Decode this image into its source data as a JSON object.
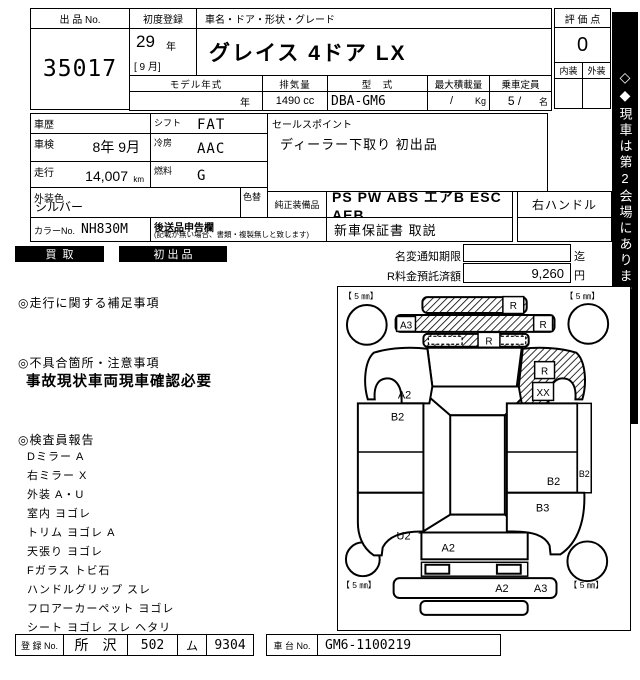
{
  "header": {
    "lot_label": "出 品 No.",
    "lot_no": "35017",
    "first_reg_label": "初度登録",
    "first_reg_year": "29",
    "first_reg_year_unit": "年",
    "first_reg_month": "[ 9 月]",
    "name_header": "車名・ドア・形状・グレード",
    "car_name": "グレイス 4ドア  LX",
    "model_year_label": "モデル年式",
    "model_year_unit": "年",
    "disp_label": "排気量",
    "disp_value": "1490 cc",
    "type_label": "型　式",
    "type_value": "DBA-GM6",
    "payload_label": "最大積載量",
    "payload_value": "/",
    "payload_unit": "Kg",
    "capacity_label": "乗車定員",
    "capacity_value": "5 /",
    "capacity_unit": "名",
    "score_label": "評 価 点",
    "score_value": "0",
    "interior_label": "内装",
    "exterior_label": "外装"
  },
  "specs": {
    "history_label": "車歴",
    "shift_label": "シフト",
    "shift_value": "FAT",
    "inspection_label": "車検",
    "inspection_value": "8年 9月",
    "cooling_label": "冷房",
    "cooling_value": "AAC",
    "mileage_label": "走行",
    "mileage_value": "14,007",
    "mileage_unit": "km",
    "fuel_label": "燃料",
    "fuel_value": "G",
    "ext_color_label": "外装色",
    "ext_color_value": "シルバー",
    "repaint_label": "色替",
    "color_no_label": "カラーNo.",
    "color_no_value": "NH830M",
    "later_label": "後送品申告欄",
    "later_note": "(記載が無い場合、書類・複製無しと致します)"
  },
  "sales": {
    "point_label": "セールスポイント",
    "point_text": "ディーラー下取り 初出品",
    "equip_label": "純正装備品",
    "equip_value": "PS PW ABS エアB ESC AEB",
    "handle_value": "右ハンドル",
    "docs_value": "新車保証書 取説"
  },
  "badges": {
    "buyout": "買取",
    "first_listing": "初出品"
  },
  "notice": {
    "name_change_label": "名変通知期限",
    "name_change_suffix": "迄",
    "deposit_label": "R料金預託済額",
    "deposit_value": "9,260",
    "deposit_unit": "円"
  },
  "sections": {
    "run_title": "◎走行に関する補足事項",
    "defect_title": "◎不具合箇所・注意事項",
    "defect_text": "事故現状車両現車確認必要",
    "inspector_title": "◎検査員報告",
    "inspector_items": [
      "Dミラー A",
      "右ミラー X",
      "外装 A・U",
      "室内 ヨゴレ",
      "トリム ヨゴレ A",
      "天張り ヨゴレ",
      "Fガラス トビ石",
      "ハンドルグリップ スレ",
      "フロアーカーペット ヨゴレ",
      "シート ヨゴレ スレ ヘタリ"
    ]
  },
  "footer": {
    "reg_label": "登 録 No.",
    "reg_area": "所　沢",
    "reg_class": "502",
    "reg_kana": "ム",
    "reg_no": "9304",
    "chassis_label": "車 台 No.",
    "chassis_value": "GM6-1100219"
  },
  "side_strip": {
    "diamond_open": "◇",
    "diamond_filled": "◆",
    "text": "現車は第2会場にあります"
  },
  "diagram": {
    "tires": {
      "fl": "【 5 ㎜】",
      "fr": "【 5 ㎜】",
      "rl": "【 5 ㎜】",
      "rr": "【 5 ㎜】"
    },
    "marks": {
      "bumper_r": "R",
      "hood_a3": "A3",
      "hood_r": "R",
      "grille_r": "R",
      "lf_fender_a2": "A2",
      "rf_fender_r": "R",
      "rf_fender_xx": "XX",
      "l_door_b2": "B2",
      "r_door_b2": "B2",
      "r_sill_b2": "B2",
      "r_quarter_b3": "B3",
      "l_quarter_u2": "U2",
      "trunk_a2": "A2",
      "r_bumper_a2": "A2",
      "r_bumper_a3": "A3"
    }
  }
}
